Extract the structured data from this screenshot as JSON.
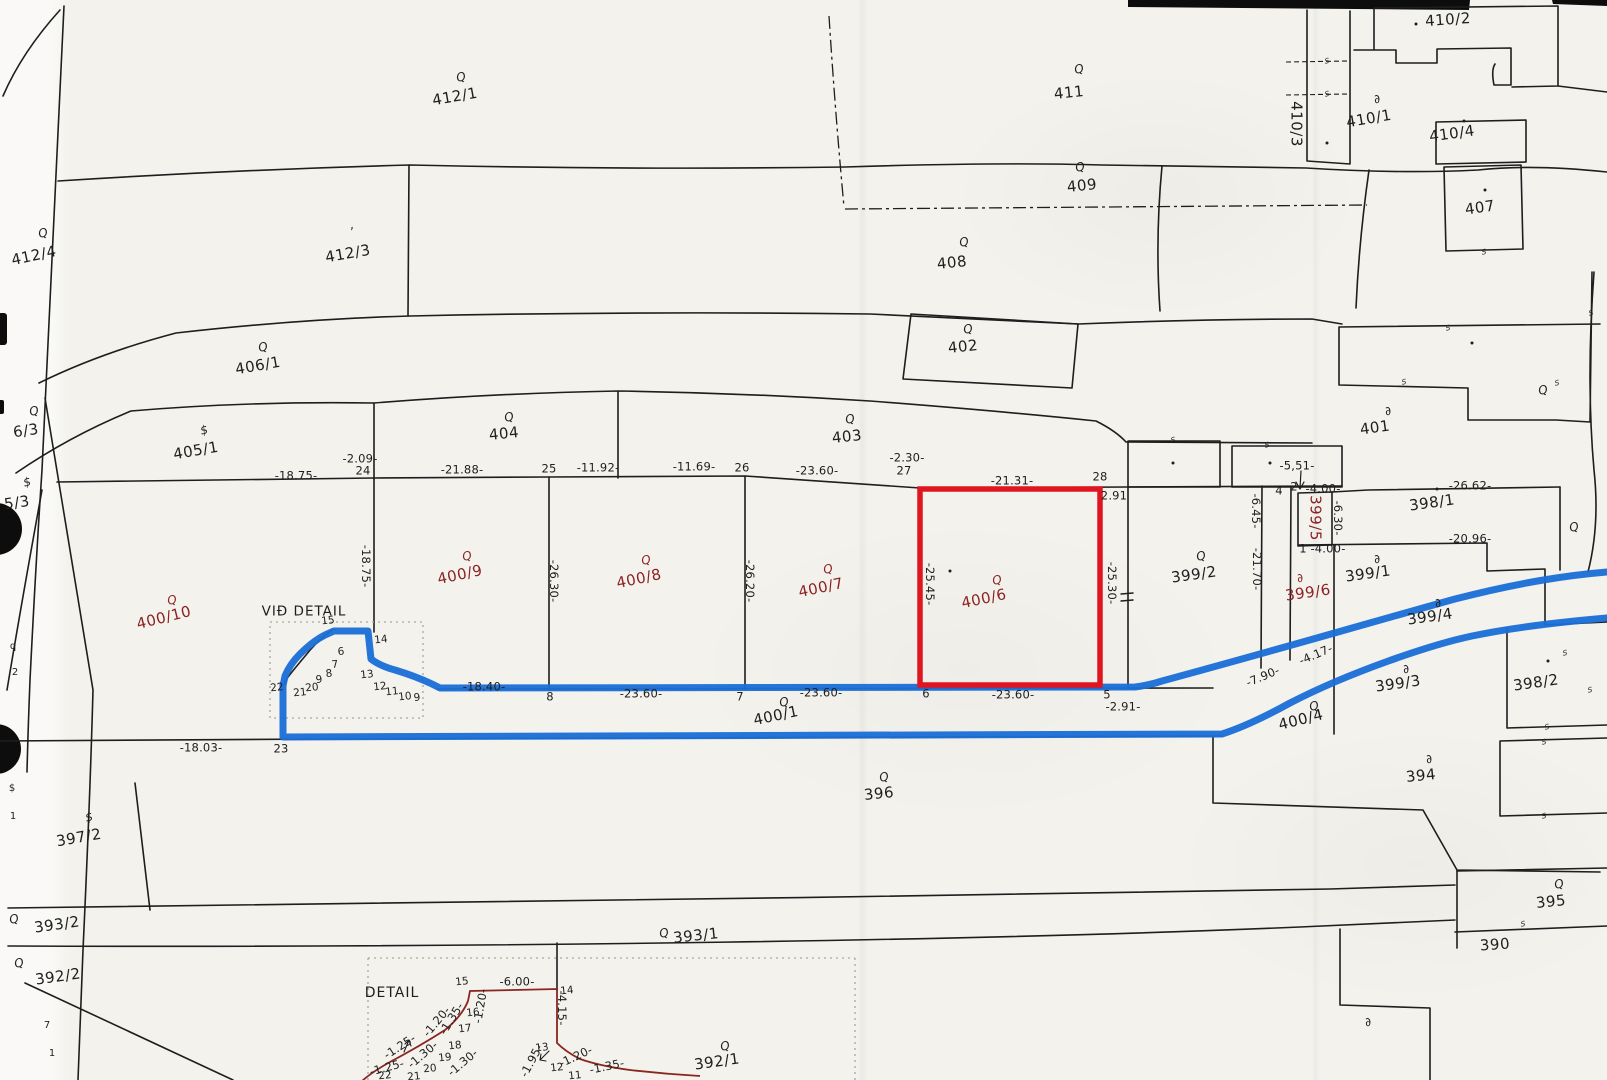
{
  "labels": {
    "vid_detail": "VIÐ DETAIL",
    "detail": "DETAIL"
  },
  "colors": {
    "paper": "#f3f2ed",
    "ink": "#1e1e1e",
    "parcel-red": "#8b2222",
    "hl-red": "#e01520",
    "hl-blue": "#1b6fd8",
    "detail-red": "#8a2520",
    "dotted-gray": "#a9a9a1"
  },
  "highlighted_parcel": "400/6",
  "parcels": [
    {
      "id": "412/1",
      "x": 455,
      "y": 97,
      "r": -10,
      "sym": "Q",
      "sx": 461,
      "sy": 77
    },
    {
      "id": "412/4",
      "x": 34,
      "y": 256,
      "r": -12,
      "sym": "Q",
      "sx": 43,
      "sy": 233
    },
    {
      "id": "412/3",
      "x": 348,
      "y": 254,
      "r": -10,
      "sym": "’",
      "sx": 352,
      "sy": 232
    },
    {
      "id": "406/1",
      "x": 258,
      "y": 366,
      "r": -10,
      "sym": "Q",
      "sx": 263,
      "sy": 347
    },
    {
      "id": "405/1",
      "x": 196,
      "y": 451,
      "r": -10,
      "sym": "$",
      "sx": 204,
      "sy": 430
    },
    {
      "id": "404",
      "x": 504,
      "y": 434,
      "r": -6,
      "sym": "Q",
      "sx": 509,
      "sy": 417
    },
    {
      "id": "403",
      "x": 847,
      "y": 437,
      "r": -6,
      "sym": "Q",
      "sx": 850,
      "sy": 419
    },
    {
      "id": "402",
      "x": 963,
      "y": 347,
      "r": -6,
      "sym": "Q",
      "sx": 968,
      "sy": 329
    },
    {
      "id": "408",
      "x": 952,
      "y": 263,
      "r": -6,
      "sym": "Q",
      "sx": 964,
      "sy": 242
    },
    {
      "id": "409",
      "x": 1082,
      "y": 186,
      "r": -6,
      "sym": "Q",
      "sx": 1080,
      "sy": 167
    },
    {
      "id": "411",
      "x": 1069,
      "y": 93,
      "r": -6,
      "sym": "Q",
      "sx": 1079,
      "sy": 69
    },
    {
      "id": "410/2",
      "x": 1448,
      "y": 20,
      "r": -4
    },
    {
      "id": "410/3",
      "x": 1296,
      "y": 124,
      "r": 90
    },
    {
      "id": "410/1",
      "x": 1369,
      "y": 119,
      "r": -10,
      "sym": "∂",
      "sx": 1377,
      "sy": 99
    },
    {
      "id": "410/4",
      "x": 1452,
      "y": 134,
      "r": -8
    },
    {
      "id": "407",
      "x": 1480,
      "y": 208,
      "r": -8
    },
    {
      "id": "401",
      "x": 1375,
      "y": 428,
      "r": -8,
      "sym": "∂",
      "sx": 1388,
      "sy": 411
    },
    {
      "id": "398/1",
      "x": 1432,
      "y": 503,
      "r": -8
    },
    {
      "id": "399/2",
      "x": 1194,
      "y": 575,
      "r": -8,
      "sym": "Q",
      "sx": 1201,
      "sy": 556
    },
    {
      "id": "399/5",
      "x": 1315,
      "y": 518,
      "r": 90,
      "c": "red"
    },
    {
      "id": "399/6",
      "x": 1308,
      "y": 593,
      "r": -8,
      "c": "red",
      "sym": "∂",
      "sx": 1300,
      "sy": 578
    },
    {
      "id": "399/1",
      "x": 1368,
      "y": 574,
      "r": -8,
      "sym": "∂",
      "sx": 1377,
      "sy": 559
    },
    {
      "id": "399/4",
      "x": 1430,
      "y": 617,
      "r": -8,
      "sym": "∂",
      "sx": 1438,
      "sy": 603
    },
    {
      "id": "399/3",
      "x": 1398,
      "y": 684,
      "r": -8,
      "sym": "∂",
      "sx": 1406,
      "sy": 669
    },
    {
      "id": "398/2",
      "x": 1536,
      "y": 683,
      "r": -8
    },
    {
      "id": "400/10",
      "x": 164,
      "y": 618,
      "r": -14,
      "c": "red",
      "sym": "Q",
      "sx": 172,
      "sy": 600
    },
    {
      "id": "400/9",
      "x": 460,
      "y": 575,
      "r": -12,
      "c": "red",
      "sym": "Q",
      "sx": 467,
      "sy": 556
    },
    {
      "id": "400/8",
      "x": 639,
      "y": 579,
      "r": -12,
      "c": "red",
      "sym": "Q",
      "sx": 646,
      "sy": 560
    },
    {
      "id": "400/7",
      "x": 821,
      "y": 588,
      "r": -12,
      "c": "red",
      "sym": "Q",
      "sx": 828,
      "sy": 569
    },
    {
      "id": "400/6",
      "x": 984,
      "y": 599,
      "r": -12,
      "c": "red",
      "sym": "Q",
      "sx": 997,
      "sy": 580
    },
    {
      "id": "400/1",
      "x": 776,
      "y": 716,
      "r": -12,
      "sym": "Q",
      "sx": 784,
      "sy": 702
    },
    {
      "id": "400/4",
      "x": 1301,
      "y": 720,
      "r": -14,
      "sym": "Q",
      "sx": 1314,
      "sy": 706
    },
    {
      "id": "394",
      "x": 1421,
      "y": 776,
      "r": -6,
      "sym": "∂",
      "sx": 1429,
      "sy": 759
    },
    {
      "id": "396",
      "x": 879,
      "y": 794,
      "r": -6,
      "sym": "Q",
      "sx": 884,
      "sy": 777
    },
    {
      "id": "397/2",
      "x": 79,
      "y": 838,
      "r": -10,
      "sym": "$",
      "sx": 89,
      "sy": 817
    },
    {
      "id": "393/2",
      "x": 57,
      "y": 925,
      "r": -8,
      "sym": "Q",
      "sx": 14,
      "sy": 919
    },
    {
      "id": "392/2",
      "x": 58,
      "y": 977,
      "r": -8,
      "sym": "Q",
      "sx": 19,
      "sy": 963
    },
    {
      "id": "393/1",
      "x": 696,
      "y": 936,
      "r": -6,
      "sym": "Q",
      "sx": 664,
      "sy": 933
    },
    {
      "id": "392/1",
      "x": 717,
      "y": 1062,
      "r": -8,
      "sym": "Q",
      "sx": 725,
      "sy": 1046
    },
    {
      "id": "390",
      "x": 1495,
      "y": 945,
      "r": -4
    },
    {
      "id": "395",
      "x": 1551,
      "y": 902,
      "r": -6,
      "sym": "Q",
      "sx": 1559,
      "sy": 884
    },
    {
      "id": "6/3",
      "x": 26,
      "y": 431,
      "r": -8,
      "sym": "Q",
      "sx": 34,
      "sy": 411
    },
    {
      "id": "5/3",
      "x": 17,
      "y": 503,
      "r": -8,
      "sym": "$",
      "sx": 27,
      "sy": 482
    },
    {
      "id": "",
      "x": 1574,
      "y": 527,
      "r": 0,
      "sym": "Q"
    },
    {
      "id": "",
      "x": 1543,
      "y": 390,
      "r": 0,
      "sym": "Q"
    },
    {
      "id": "",
      "x": 1368,
      "y": 1022,
      "r": 0,
      "sym": "∂"
    }
  ],
  "measurements": [
    {
      "t": "-18.75-",
      "x": 296,
      "y": 476
    },
    {
      "t": "-2.09-",
      "x": 360,
      "y": 459
    },
    {
      "t": "24",
      "x": 363,
      "y": 471
    },
    {
      "t": "-21.88-",
      "x": 462,
      "y": 470
    },
    {
      "t": "25",
      "x": 549,
      "y": 469
    },
    {
      "t": "-11.92-",
      "x": 598,
      "y": 468
    },
    {
      "t": "-11.69-",
      "x": 694,
      "y": 467
    },
    {
      "t": "26",
      "x": 742,
      "y": 468
    },
    {
      "t": "-23.60-",
      "x": 817,
      "y": 471
    },
    {
      "t": "-2.30-",
      "x": 907,
      "y": 458
    },
    {
      "t": "27",
      "x": 904,
      "y": 471
    },
    {
      "t": "-21.31-",
      "x": 1012,
      "y": 481
    },
    {
      "t": "28",
      "x": 1100,
      "y": 477
    },
    {
      "t": "2.91",
      "x": 1114,
      "y": 496
    },
    {
      "t": "-5,51-",
      "x": 1297,
      "y": 466
    },
    {
      "t": "-4.00-",
      "x": 1323,
      "y": 489
    },
    {
      "t": "2",
      "x": 1294,
      "y": 487
    },
    {
      "t": "4",
      "x": 1279,
      "y": 491
    },
    {
      "t": "1",
      "x": 1303,
      "y": 549
    },
    {
      "t": "-4.00-",
      "x": 1328,
      "y": 549
    },
    {
      "t": "-26.62-",
      "x": 1470,
      "y": 486
    },
    {
      "t": "-20.96-",
      "x": 1470,
      "y": 539
    },
    {
      "t": "-6.45-",
      "x": 1255,
      "y": 511,
      "r": 90
    },
    {
      "t": "-6.30-",
      "x": 1337,
      "y": 518,
      "r": 90
    },
    {
      "t": "-21.70-",
      "x": 1256,
      "y": 569,
      "r": 90
    },
    {
      "t": "-18.75-",
      "x": 365,
      "y": 566,
      "r": 90
    },
    {
      "t": "-26.30-",
      "x": 553,
      "y": 581,
      "r": 90
    },
    {
      "t": "-26.20-",
      "x": 749,
      "y": 581,
      "r": 90
    },
    {
      "t": "-25.45-",
      "x": 929,
      "y": 584,
      "r": 90
    },
    {
      "t": "-25.30-",
      "x": 1111,
      "y": 583,
      "r": 90
    },
    {
      "t": "-18.40-",
      "x": 484,
      "y": 687
    },
    {
      "t": "8",
      "x": 550,
      "y": 697
    },
    {
      "t": "-23.60-",
      "x": 641,
      "y": 694
    },
    {
      "t": "7",
      "x": 740,
      "y": 697
    },
    {
      "t": "-23.60-",
      "x": 821,
      "y": 693
    },
    {
      "t": "6",
      "x": 926,
      "y": 694
    },
    {
      "t": "-23.60-",
      "x": 1013,
      "y": 695
    },
    {
      "t": "5",
      "x": 1107,
      "y": 695
    },
    {
      "t": "-2.91-",
      "x": 1123,
      "y": 707
    },
    {
      "t": "-18.03-",
      "x": 201,
      "y": 748
    },
    {
      "t": "23",
      "x": 281,
      "y": 749
    },
    {
      "t": "-7.90-",
      "x": 1263,
      "y": 677,
      "r": -23
    },
    {
      "t": "-4.17-",
      "x": 1316,
      "y": 655,
      "r": -23
    },
    {
      "t": "-6.00-",
      "x": 517,
      "y": 982
    },
    {
      "t": "-4.15-",
      "x": 561,
      "y": 1008,
      "r": 90
    },
    {
      "t": "-1.20-",
      "x": 481,
      "y": 1006,
      "r": -80
    },
    {
      "t": "-1.35-",
      "x": 452,
      "y": 1019,
      "r": -58
    },
    {
      "t": "-1.20-",
      "x": 437,
      "y": 1022,
      "r": -50
    },
    {
      "t": "-1.30-",
      "x": 423,
      "y": 1055,
      "r": -40
    },
    {
      "t": "-1.25-",
      "x": 400,
      "y": 1047,
      "r": -33
    },
    {
      "t": "-1.25-",
      "x": 387,
      "y": 1068,
      "r": -15
    },
    {
      "t": "-1.30-",
      "x": 463,
      "y": 1063,
      "r": -40
    },
    {
      "t": "-1.95-",
      "x": 532,
      "y": 1061,
      "r": -62
    },
    {
      "t": "-1.20-",
      "x": 576,
      "y": 1057,
      "r": -25
    },
    {
      "t": "-1.35-",
      "x": 607,
      "y": 1067,
      "r": -12
    }
  ],
  "points": [
    {
      "t": "15",
      "x": 328,
      "y": 621
    },
    {
      "t": "14",
      "x": 381,
      "y": 640
    },
    {
      "t": "6",
      "x": 341,
      "y": 652
    },
    {
      "t": "7",
      "x": 335,
      "y": 665
    },
    {
      "t": "8",
      "x": 329,
      "y": 674
    },
    {
      "t": "9",
      "x": 319,
      "y": 680
    },
    {
      "t": "20",
      "x": 312,
      "y": 688
    },
    {
      "t": "21",
      "x": 300,
      "y": 693
    },
    {
      "t": "22",
      "x": 277,
      "y": 688
    },
    {
      "t": "13",
      "x": 367,
      "y": 675
    },
    {
      "t": "12",
      "x": 380,
      "y": 687
    },
    {
      "t": "11",
      "x": 392,
      "y": 692
    },
    {
      "t": "10",
      "x": 405,
      "y": 697
    },
    {
      "t": "9",
      "x": 417,
      "y": 698
    },
    {
      "t": "15",
      "x": 462,
      "y": 982
    },
    {
      "t": "14",
      "x": 567,
      "y": 991
    },
    {
      "t": "16",
      "x": 473,
      "y": 1013
    },
    {
      "t": "17",
      "x": 465,
      "y": 1029
    },
    {
      "t": "18",
      "x": 455,
      "y": 1046
    },
    {
      "t": "19",
      "x": 445,
      "y": 1058
    },
    {
      "t": "20",
      "x": 430,
      "y": 1069
    },
    {
      "t": "21",
      "x": 414,
      "y": 1077
    },
    {
      "t": "22",
      "x": 385,
      "y": 1076
    },
    {
      "t": "13",
      "x": 542,
      "y": 1048
    },
    {
      "t": "12",
      "x": 557,
      "y": 1068
    },
    {
      "t": "11",
      "x": 575,
      "y": 1076
    }
  ],
  "survey_marks": [
    [
      1327,
      61
    ],
    [
      1327,
      94
    ],
    [
      1173,
      440
    ],
    [
      1267,
      445
    ],
    [
      1448,
      328
    ],
    [
      1404,
      382
    ],
    [
      1557,
      383
    ],
    [
      1484,
      252
    ],
    [
      1591,
      313
    ],
    [
      1565,
      653
    ],
    [
      1590,
      690
    ],
    [
      1547,
      727
    ],
    [
      1544,
      742
    ],
    [
      1544,
      816
    ],
    [
      1523,
      924
    ]
  ],
  "dots": [
    [
      1416,
      24
    ],
    [
      1464,
      121
    ],
    [
      1485,
      190
    ],
    [
      1437,
      489
    ],
    [
      1173,
      463
    ],
    [
      1270,
      463
    ],
    [
      950,
      571
    ],
    [
      1548,
      661
    ],
    [
      1327,
      143
    ],
    [
      1472,
      343
    ]
  ],
  "fragments": [
    {
      "t": "$",
      "x": 12,
      "y": 789
    },
    {
      "t": "1",
      "x": 13,
      "y": 817
    },
    {
      "t": "q",
      "x": 13,
      "y": 647
    },
    {
      "t": "2",
      "x": 15,
      "y": 673
    },
    {
      "t": "7",
      "x": 47,
      "y": 1026
    },
    {
      "t": "1",
      "x": 52,
      "y": 1054
    }
  ]
}
